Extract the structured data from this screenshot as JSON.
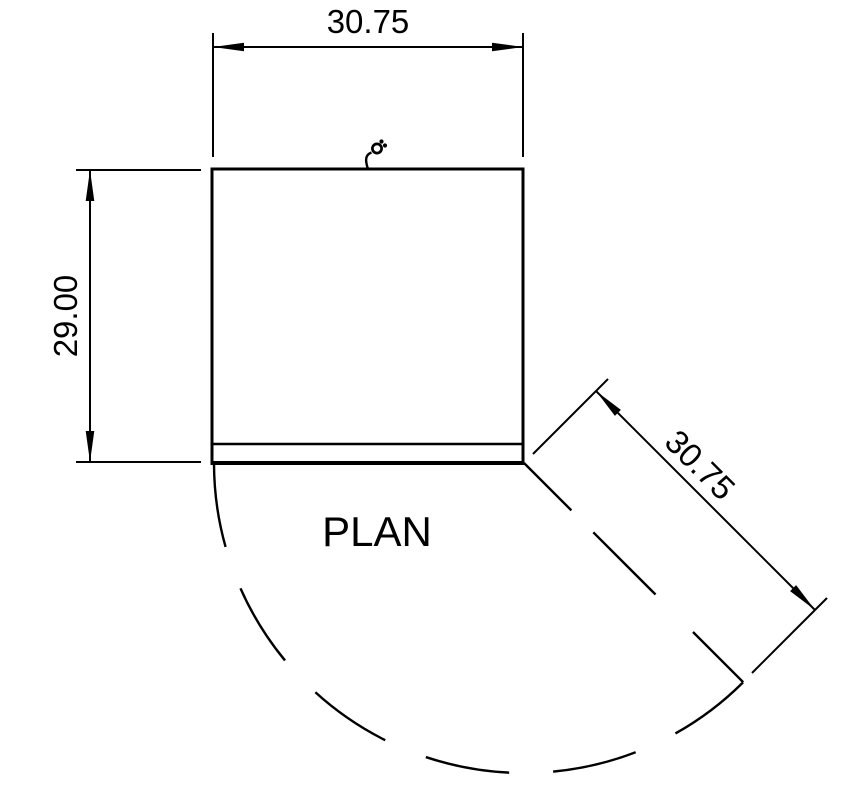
{
  "drawing": {
    "label": "PLAN",
    "dim_width_top": "30.75",
    "dim_depth_left": "29.00",
    "dim_swing_diagonal": "30.75",
    "line_color": "#000000",
    "background_color": "#ffffff"
  }
}
